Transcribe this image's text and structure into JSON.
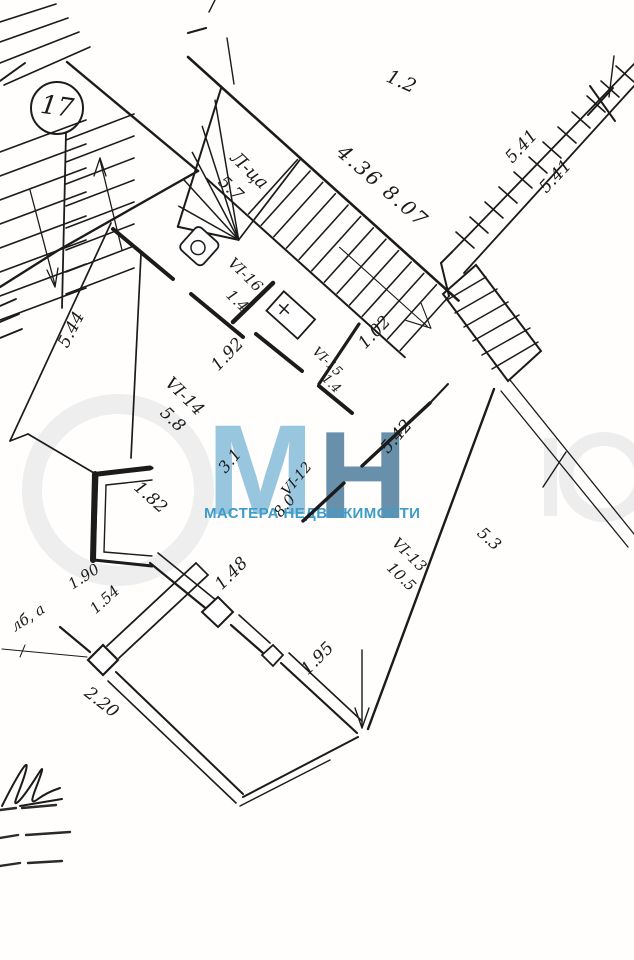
{
  "document": {
    "type": "scanned floor plan (technical drawing)",
    "ink_color": "#1b1b1b",
    "paper_color": "#fffefd"
  },
  "labels": {
    "unit_badge": "17",
    "stair_room_name": "Л-ца",
    "stair_room_area": "5.7",
    "dim_top": "4.36  8.07",
    "dim_12": "1.2",
    "dim_541a": "5.41",
    "dim_541b": "5.41",
    "dim_544": "5.44",
    "room_vi16_name": "VI-16",
    "room_vi16_area": "1.4",
    "dim_192": "1.92",
    "room_vi15_name": "VI-15",
    "room_vi15_area": "1.4",
    "dim_102": "1.02",
    "room_vi14_name": "VI-14",
    "room_vi14_area": "5.8",
    "dim_182": "1.82",
    "dim_31": "3.1",
    "room_vi12_name": "VI-12",
    "room_vi12_area": "8.0",
    "dim_542": "5.42",
    "room_vi13_name": "VI-13",
    "room_vi13_area": "10.5",
    "dim_53": "5.3",
    "dim_148": "1.48",
    "dim_195": "1.95",
    "dim_190": "1.90",
    "dim_154": "1.54",
    "dim_220": "2.20",
    "note_left": "лб, а"
  },
  "watermark": {
    "letter_m": "М",
    "letter_n": "Н",
    "tagline": "МАСТЕРА НЕДВИЖИМОСТИ",
    "color_m": "#8abfdb",
    "color_n": "#5d87a5",
    "color_tagline": "#3d9cc9"
  }
}
